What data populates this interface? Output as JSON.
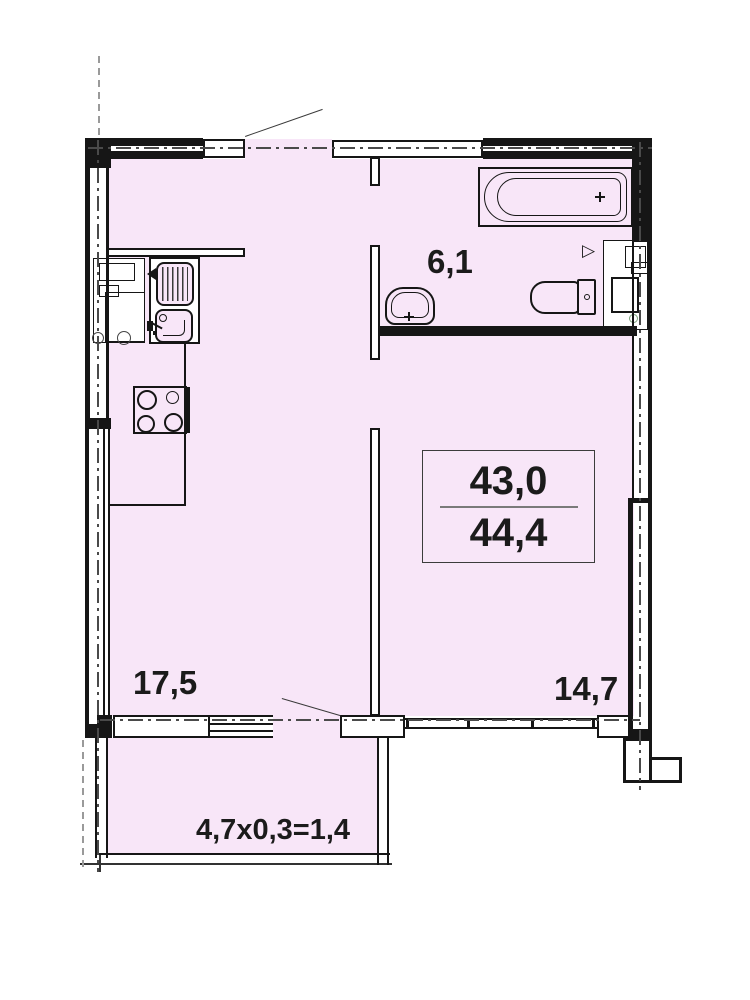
{
  "rooms": {
    "bathroom": {
      "area_label": "6,1"
    },
    "kitchen_living": {
      "area_label": "17,5"
    },
    "bedroom": {
      "area_label": "14,7"
    }
  },
  "area_stamp": {
    "living_area": "43,0",
    "total_area": "44,4"
  },
  "balcony": {
    "area_formula": "4,7x0,3=1,4"
  },
  "markers": {
    "door_triangle": "▷"
  },
  "fixtures": [
    "bathtub",
    "washbasin",
    "toilet",
    "kitchen-sink",
    "stove",
    "ventilation-shaft",
    "kitchen-counter"
  ],
  "colors": {
    "room_fill": "#f8e6f8",
    "line": "#161616",
    "centerline": "#4a4a4a",
    "vent_marker": "#7da37d"
  }
}
